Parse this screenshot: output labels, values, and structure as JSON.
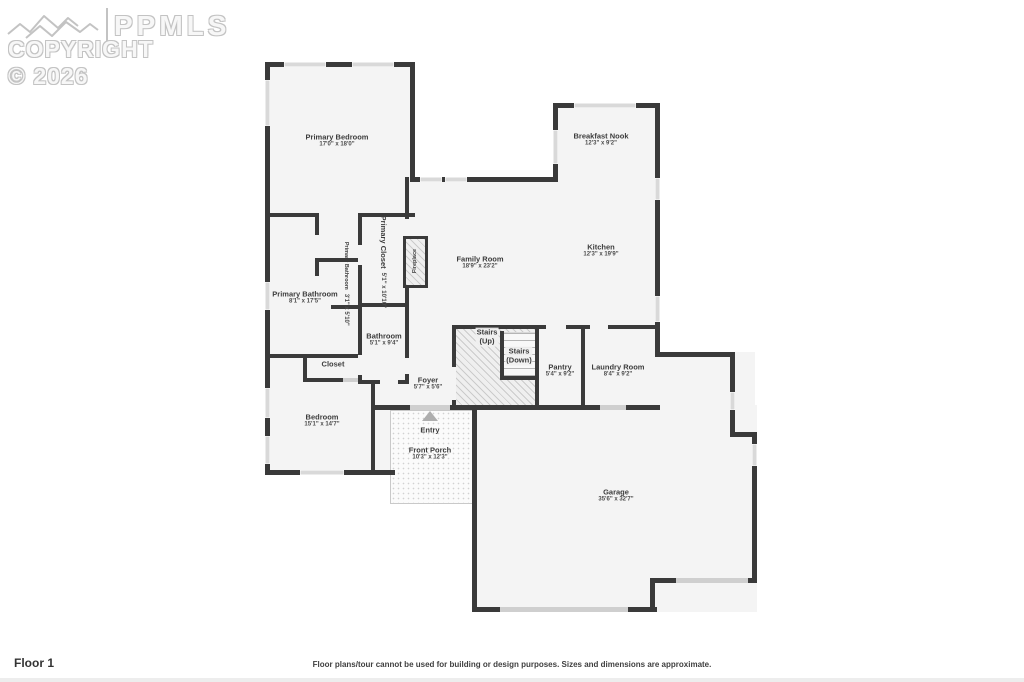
{
  "watermark": {
    "logo_text": "PPMLS",
    "copyright": "COPYRIGHT © 2026"
  },
  "plan": {
    "floor_label": "Floor 1",
    "disclaimer": "Floor plans/tour cannot be used for building or design purposes. Sizes and dimensions are approximate.",
    "rooms": [
      {
        "id": "primary-bedroom",
        "name": "Primary Bedroom",
        "dims": "17'0\" x 18'0\""
      },
      {
        "id": "breakfast-nook",
        "name": "Breakfast Nook",
        "dims": "12'3\" x 9'2\""
      },
      {
        "id": "kitchen",
        "name": "Kitchen",
        "dims": "12'3\" x 19'9\""
      },
      {
        "id": "family-room",
        "name": "Family Room",
        "dims": "18'9\" x 23'2\""
      },
      {
        "id": "primary-closet",
        "name": "Primary Closet",
        "dims": "5'1\" x 10'10\""
      },
      {
        "id": "fireplace",
        "name": "Fireplace",
        "dims": ""
      },
      {
        "id": "primary-bathroom-wc",
        "name": "Primary Bathroom",
        "dims": "3'1\" x 5'10\""
      },
      {
        "id": "primary-bathroom",
        "name": "Primary Bathroom",
        "dims": "8'1\" x 17'5\""
      },
      {
        "id": "bathroom",
        "name": "Bathroom",
        "dims": "5'1\" x 9'4\""
      },
      {
        "id": "closet",
        "name": "Closet",
        "dims": ""
      },
      {
        "id": "stairs-up",
        "name": "Stairs",
        "dims": "(Up)"
      },
      {
        "id": "stairs-down",
        "name": "Stairs",
        "dims": "(Down)"
      },
      {
        "id": "pantry",
        "name": "Pantry",
        "dims": "5'4\" x 9'2\""
      },
      {
        "id": "laundry-room",
        "name": "Laundry Room",
        "dims": "8'4\" x 9'2\""
      },
      {
        "id": "foyer",
        "name": "Foyer",
        "dims": "5'7\" x 5'6\""
      },
      {
        "id": "bedroom",
        "name": "Bedroom",
        "dims": "15'1\" x 14'7\""
      },
      {
        "id": "entry",
        "name": "Entry",
        "dims": ""
      },
      {
        "id": "front-porch",
        "name": "Front Porch",
        "dims": "10'3\" x 12'3\""
      },
      {
        "id": "garage",
        "name": "Garage",
        "dims": "35'6\" x 32'7\""
      }
    ]
  },
  "colors": {
    "wall": "#3a3a3a",
    "room_fill": "#f4f4f4",
    "window": "#d9d9d9",
    "door": "#cfcfcf",
    "watermark": "#c3c3c3",
    "label_text": "#3c3c3c"
  }
}
